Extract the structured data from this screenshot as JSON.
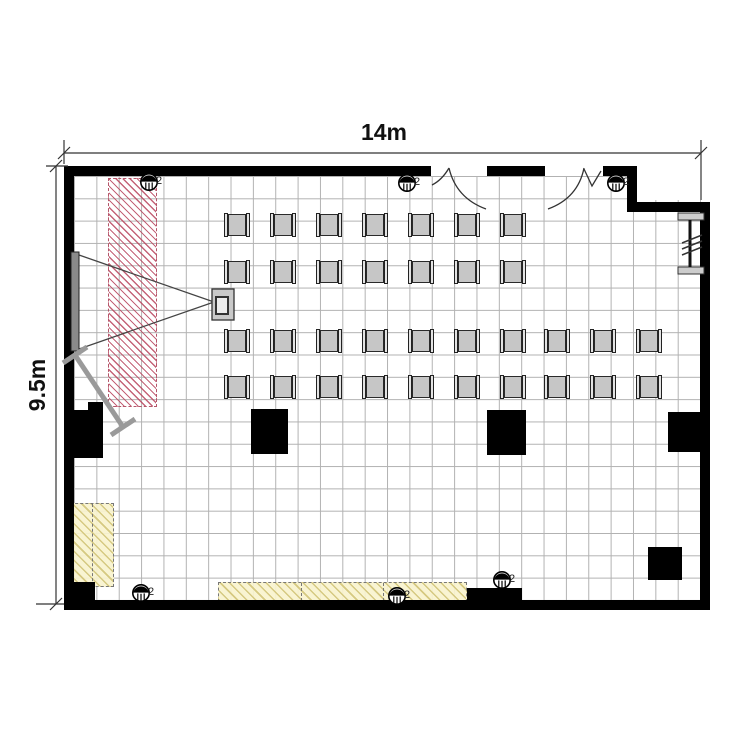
{
  "dimensions": {
    "top_label": "14m",
    "left_label": "9.5m"
  },
  "outlets": [
    {
      "x": 149,
      "y": 182,
      "label": "2"
    },
    {
      "x": 407,
      "y": 183,
      "label": "2"
    },
    {
      "x": 616,
      "y": 183,
      "label": "2"
    },
    {
      "x": 141,
      "y": 593,
      "label": "2"
    },
    {
      "x": 397,
      "y": 596,
      "label": "2"
    },
    {
      "x": 502,
      "y": 580,
      "label": "2"
    }
  ],
  "chairs": {
    "rows": [
      {
        "cy": 225,
        "cxs": [
          237,
          283,
          329,
          375,
          421,
          467,
          513
        ]
      },
      {
        "cy": 272,
        "cxs": [
          237,
          283,
          329,
          375,
          421,
          467,
          513
        ]
      },
      {
        "cy": 341,
        "cxs": [
          237,
          283,
          329,
          375,
          421,
          467,
          513,
          557,
          603,
          649
        ]
      },
      {
        "cy": 387,
        "cxs": [
          237,
          283,
          329,
          375,
          421,
          467,
          513,
          557,
          603,
          649
        ]
      }
    ]
  },
  "columns": [
    {
      "x": 67,
      "y": 410,
      "w": 36,
      "h": 48
    },
    {
      "x": 88,
      "y": 402,
      "w": 15,
      "h": 9
    },
    {
      "x": 251,
      "y": 409,
      "w": 37,
      "h": 45
    },
    {
      "x": 487,
      "y": 410,
      "w": 39,
      "h": 45
    },
    {
      "x": 668,
      "y": 412,
      "w": 36,
      "h": 40
    },
    {
      "x": 648,
      "y": 547,
      "w": 34,
      "h": 33
    },
    {
      "x": 467,
      "y": 588,
      "w": 55,
      "h": 18
    },
    {
      "x": 64,
      "y": 582,
      "w": 31,
      "h": 26
    }
  ]
}
